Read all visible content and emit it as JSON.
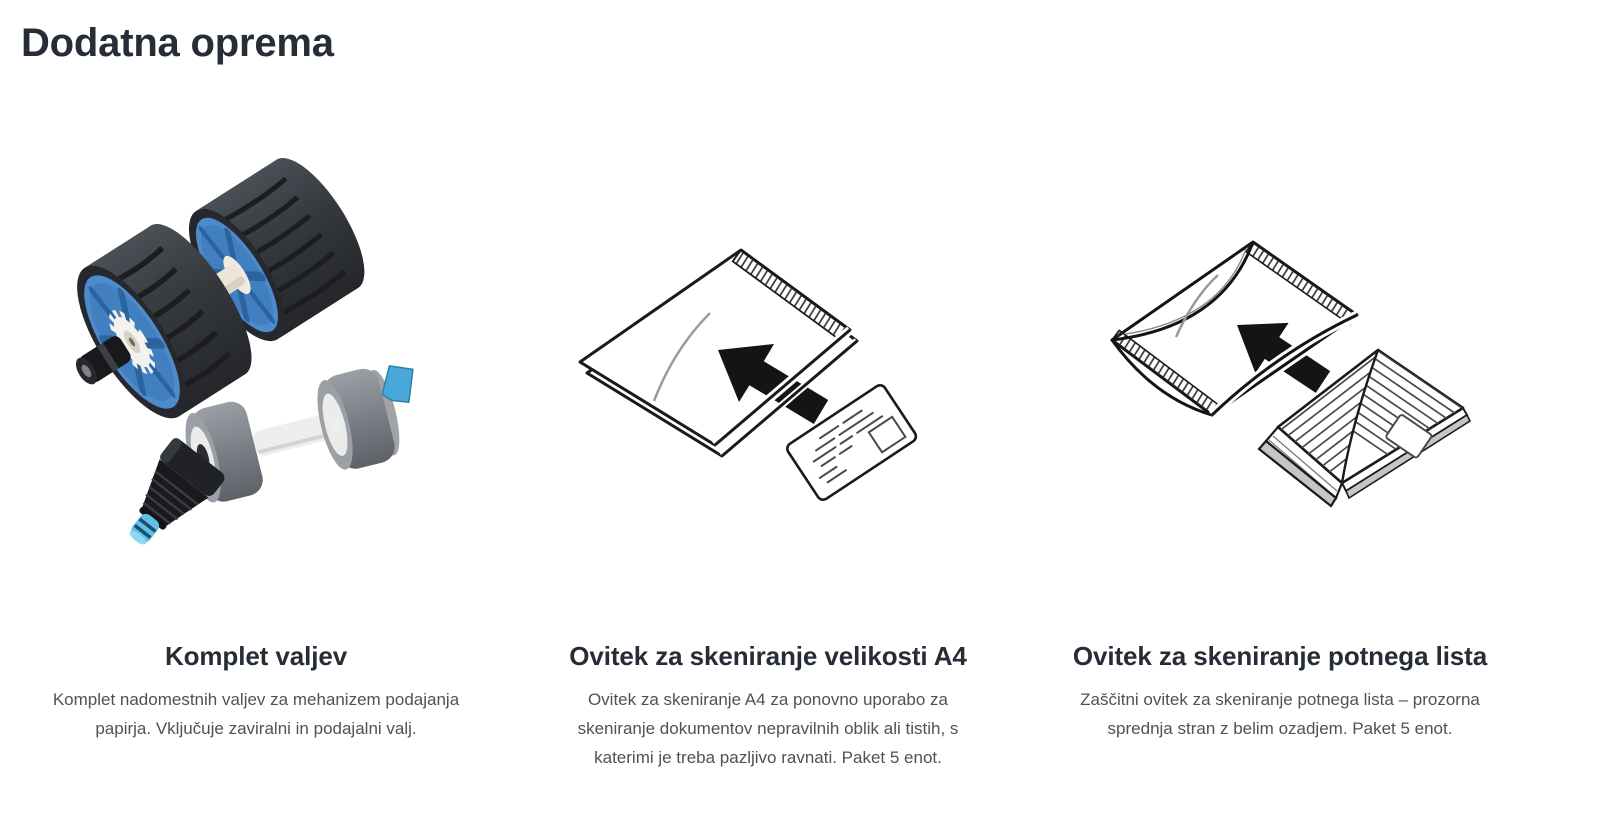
{
  "page": {
    "title": "Dodatna oprema"
  },
  "accessories": [
    {
      "name": "Komplet valjev",
      "description": "Komplet nadomestnih valjev za mehanizem podajanja\npapirja. Vključuje zaviralni in podajalni valj.",
      "image": "roller-kit-photo"
    },
    {
      "name": "Ovitek za skeniranje velikosti A4",
      "description": "Ovitek za skeniranje A4 za ponovno uporabo za\nskeniranje dokumentov nepravilnih oblik ali tistih, s\nkaterimi je treba pazljivo ravnati. Paket 5 enot.",
      "image": "a4-carrier-sheet-illustration"
    },
    {
      "name": "Ovitek za skeniranje potnega lista",
      "description": "Zaščitni ovitek za skeniranje potnega lista – prozorna\nsprednja stran z belim ozadjem. Paket 5 enot.",
      "image": "passport-carrier-sheet-illustration"
    }
  ],
  "colors": {
    "heading": "#272d36",
    "body_text": "#4e5256",
    "line_art": "#1a1a1a",
    "roller_blue": "#4e8bcc",
    "roller_tread": "#35383d",
    "roller_gray": "#7b7f86",
    "clip_blue": "#49a8d8",
    "background": "#ffffff"
  }
}
